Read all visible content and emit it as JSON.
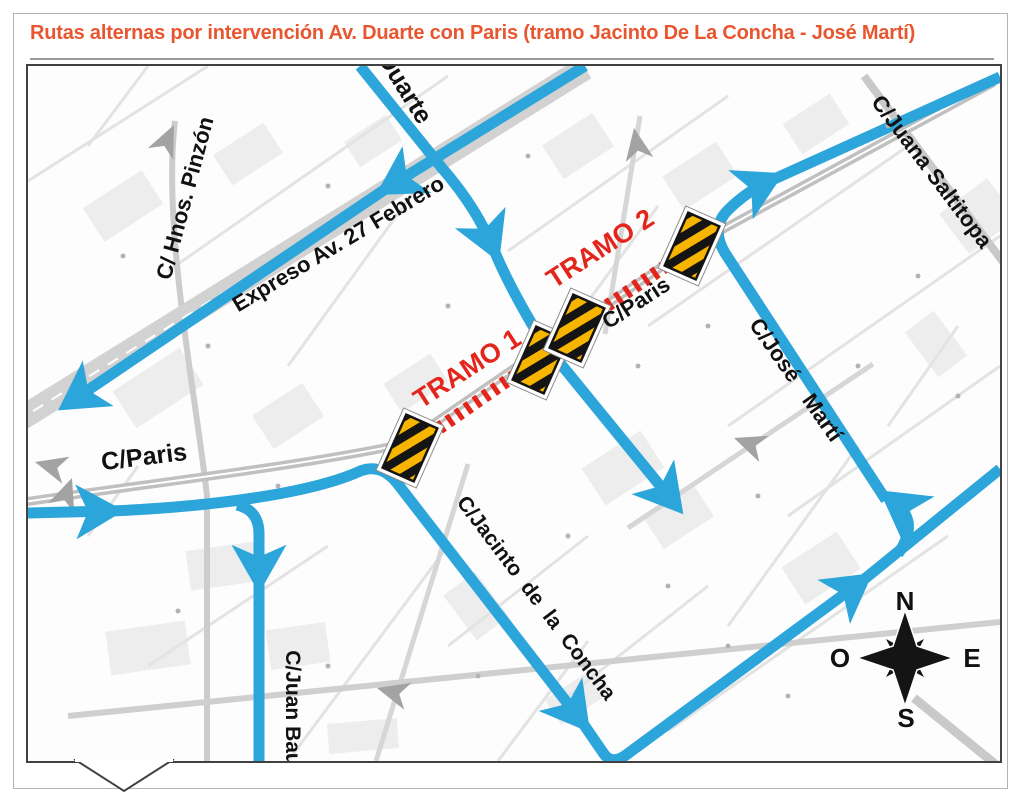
{
  "header": {
    "title": "Rutas alternas por intervención Av. Duarte con Paris (tramo Jacinto De La Concha - José Martí)"
  },
  "colors": {
    "accent_orange": "#E8562F",
    "route_blue": "#2CA5DB",
    "closure_red": "#E3251B",
    "barrier_yellow": "#F7B500",
    "road_gray": "#C4C4C4"
  },
  "map": {
    "streets": [
      {
        "id": "duarte",
        "text": "Duarte"
      },
      {
        "id": "hnos-pinzon",
        "text": "C/ Hnos. Pinzón"
      },
      {
        "id": "expreso-27",
        "text": "Expreso Av. 27 Febrero"
      },
      {
        "id": "saltitopa",
        "text": "C/Juana Saltitopa"
      },
      {
        "id": "paris-mid",
        "text": "C/Paris"
      },
      {
        "id": "paris-left",
        "text": "C/Paris"
      },
      {
        "id": "jose-marti",
        "text": "C/José Martí"
      },
      {
        "id": "jacinto",
        "text": "C/Jacinto de la Concha"
      },
      {
        "id": "juan-bau",
        "text": "C/Juan Bau"
      }
    ],
    "closures": [
      {
        "label": "TRAMO 1"
      },
      {
        "label": "TRAMO 2"
      }
    ],
    "compass": {
      "n": "N",
      "s": "S",
      "e": "E",
      "o": "O"
    }
  }
}
